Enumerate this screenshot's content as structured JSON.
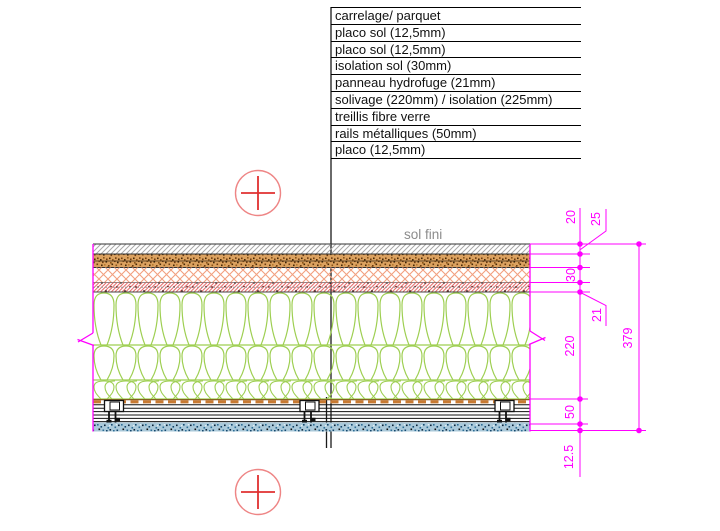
{
  "legend": {
    "rows": [
      "carrelage/ parquet",
      "placo sol (12,5mm)",
      "placo sol (12,5mm)",
      "isolation sol (30mm)",
      "panneau hydrofuge (21mm)",
      "solivage (220mm) / isolation (225mm)",
      "treillis fibre verre",
      "rails métalliques (50mm)",
      "placo (12,5mm)"
    ]
  },
  "annotations": {
    "floor_finish": "sol fini"
  },
  "dimensions": {
    "carrelage": "20",
    "placo_sol": "25",
    "isolation_sol": "30",
    "hydrofuge": "21",
    "solivage": "220",
    "rails": "50",
    "placo": "12.5",
    "total": "379"
  },
  "colors": {
    "dimension_magenta": "#ff00ff",
    "target_red": "#e03030",
    "target_circle": "#ee8585",
    "annotation_gray": "#8c8c8c",
    "insulation_green": "#9ecf52",
    "isolation_orange": "#f2a080",
    "hydrofuge_red": "#e45858",
    "treillis_brown": "#c87a32",
    "placo_blue_base": "#aac9da",
    "screed_brown_base": "#dca260",
    "carrelage_gray": "#a9a9a9"
  }
}
